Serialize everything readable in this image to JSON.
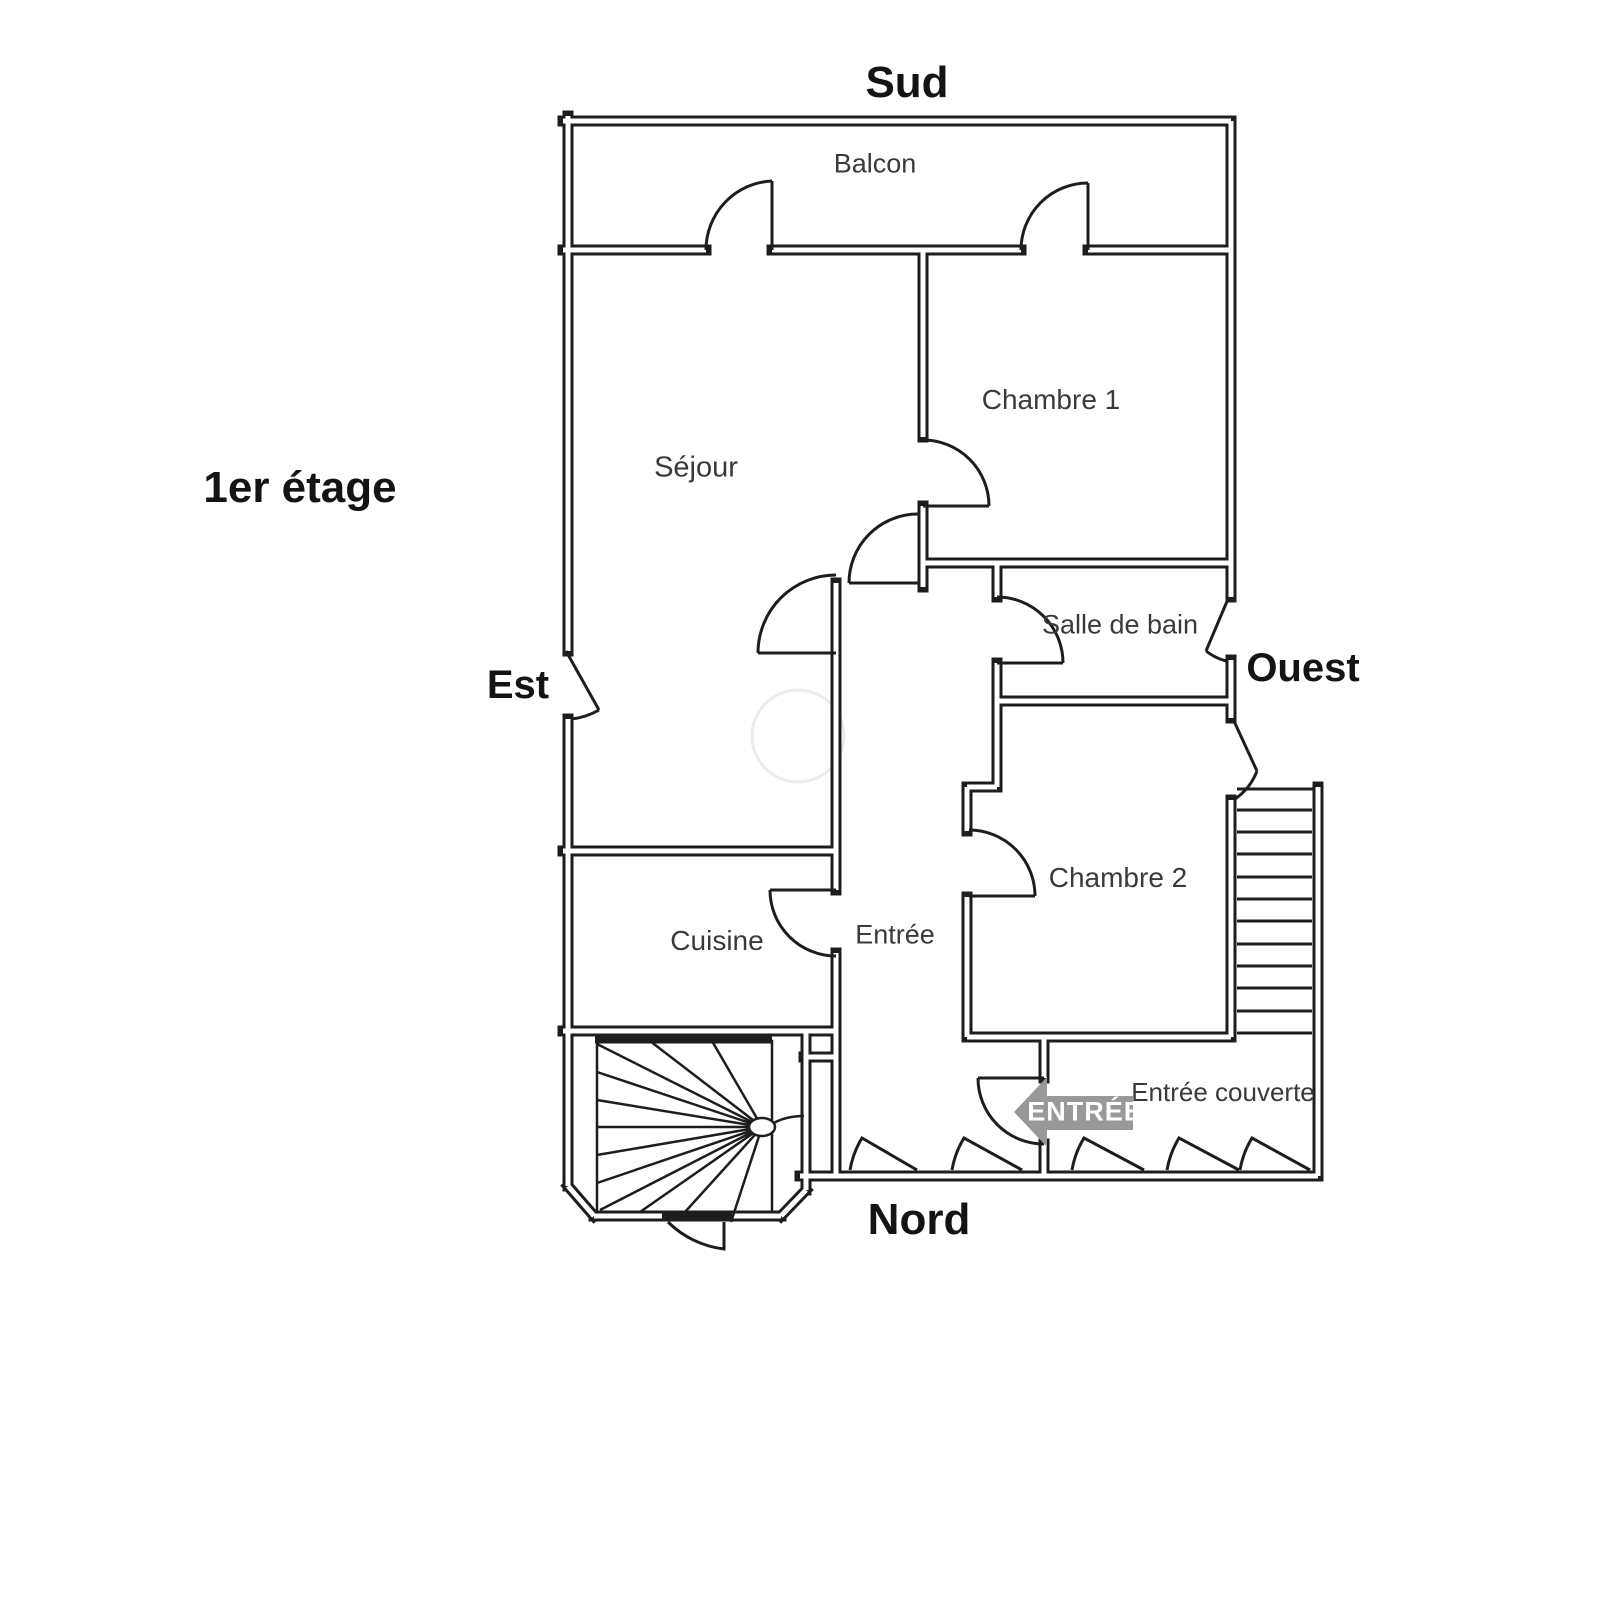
{
  "floor_plan": {
    "title": "1er étage",
    "compass": {
      "south": "Sud",
      "north": "Nord",
      "east": "Est",
      "west": "Ouest"
    },
    "rooms": {
      "balcon": "Balcon",
      "sejour": "Séjour",
      "chambre1": "Chambre 1",
      "salle_de_bain": "Salle de bain",
      "chambre2": "Chambre 2",
      "cuisine": "Cuisine",
      "entree": "Entrée",
      "entree_couverte": "Entrée couverte"
    },
    "entrance_arrow_label": "ENTRÉE",
    "colors": {
      "wall": "#1d1d1d",
      "background": "#ffffff",
      "room_label": "#3a3a3a",
      "direction_label": "#141414",
      "arrow_fill": "#999999",
      "arrow_text": "#ffffff"
    }
  }
}
